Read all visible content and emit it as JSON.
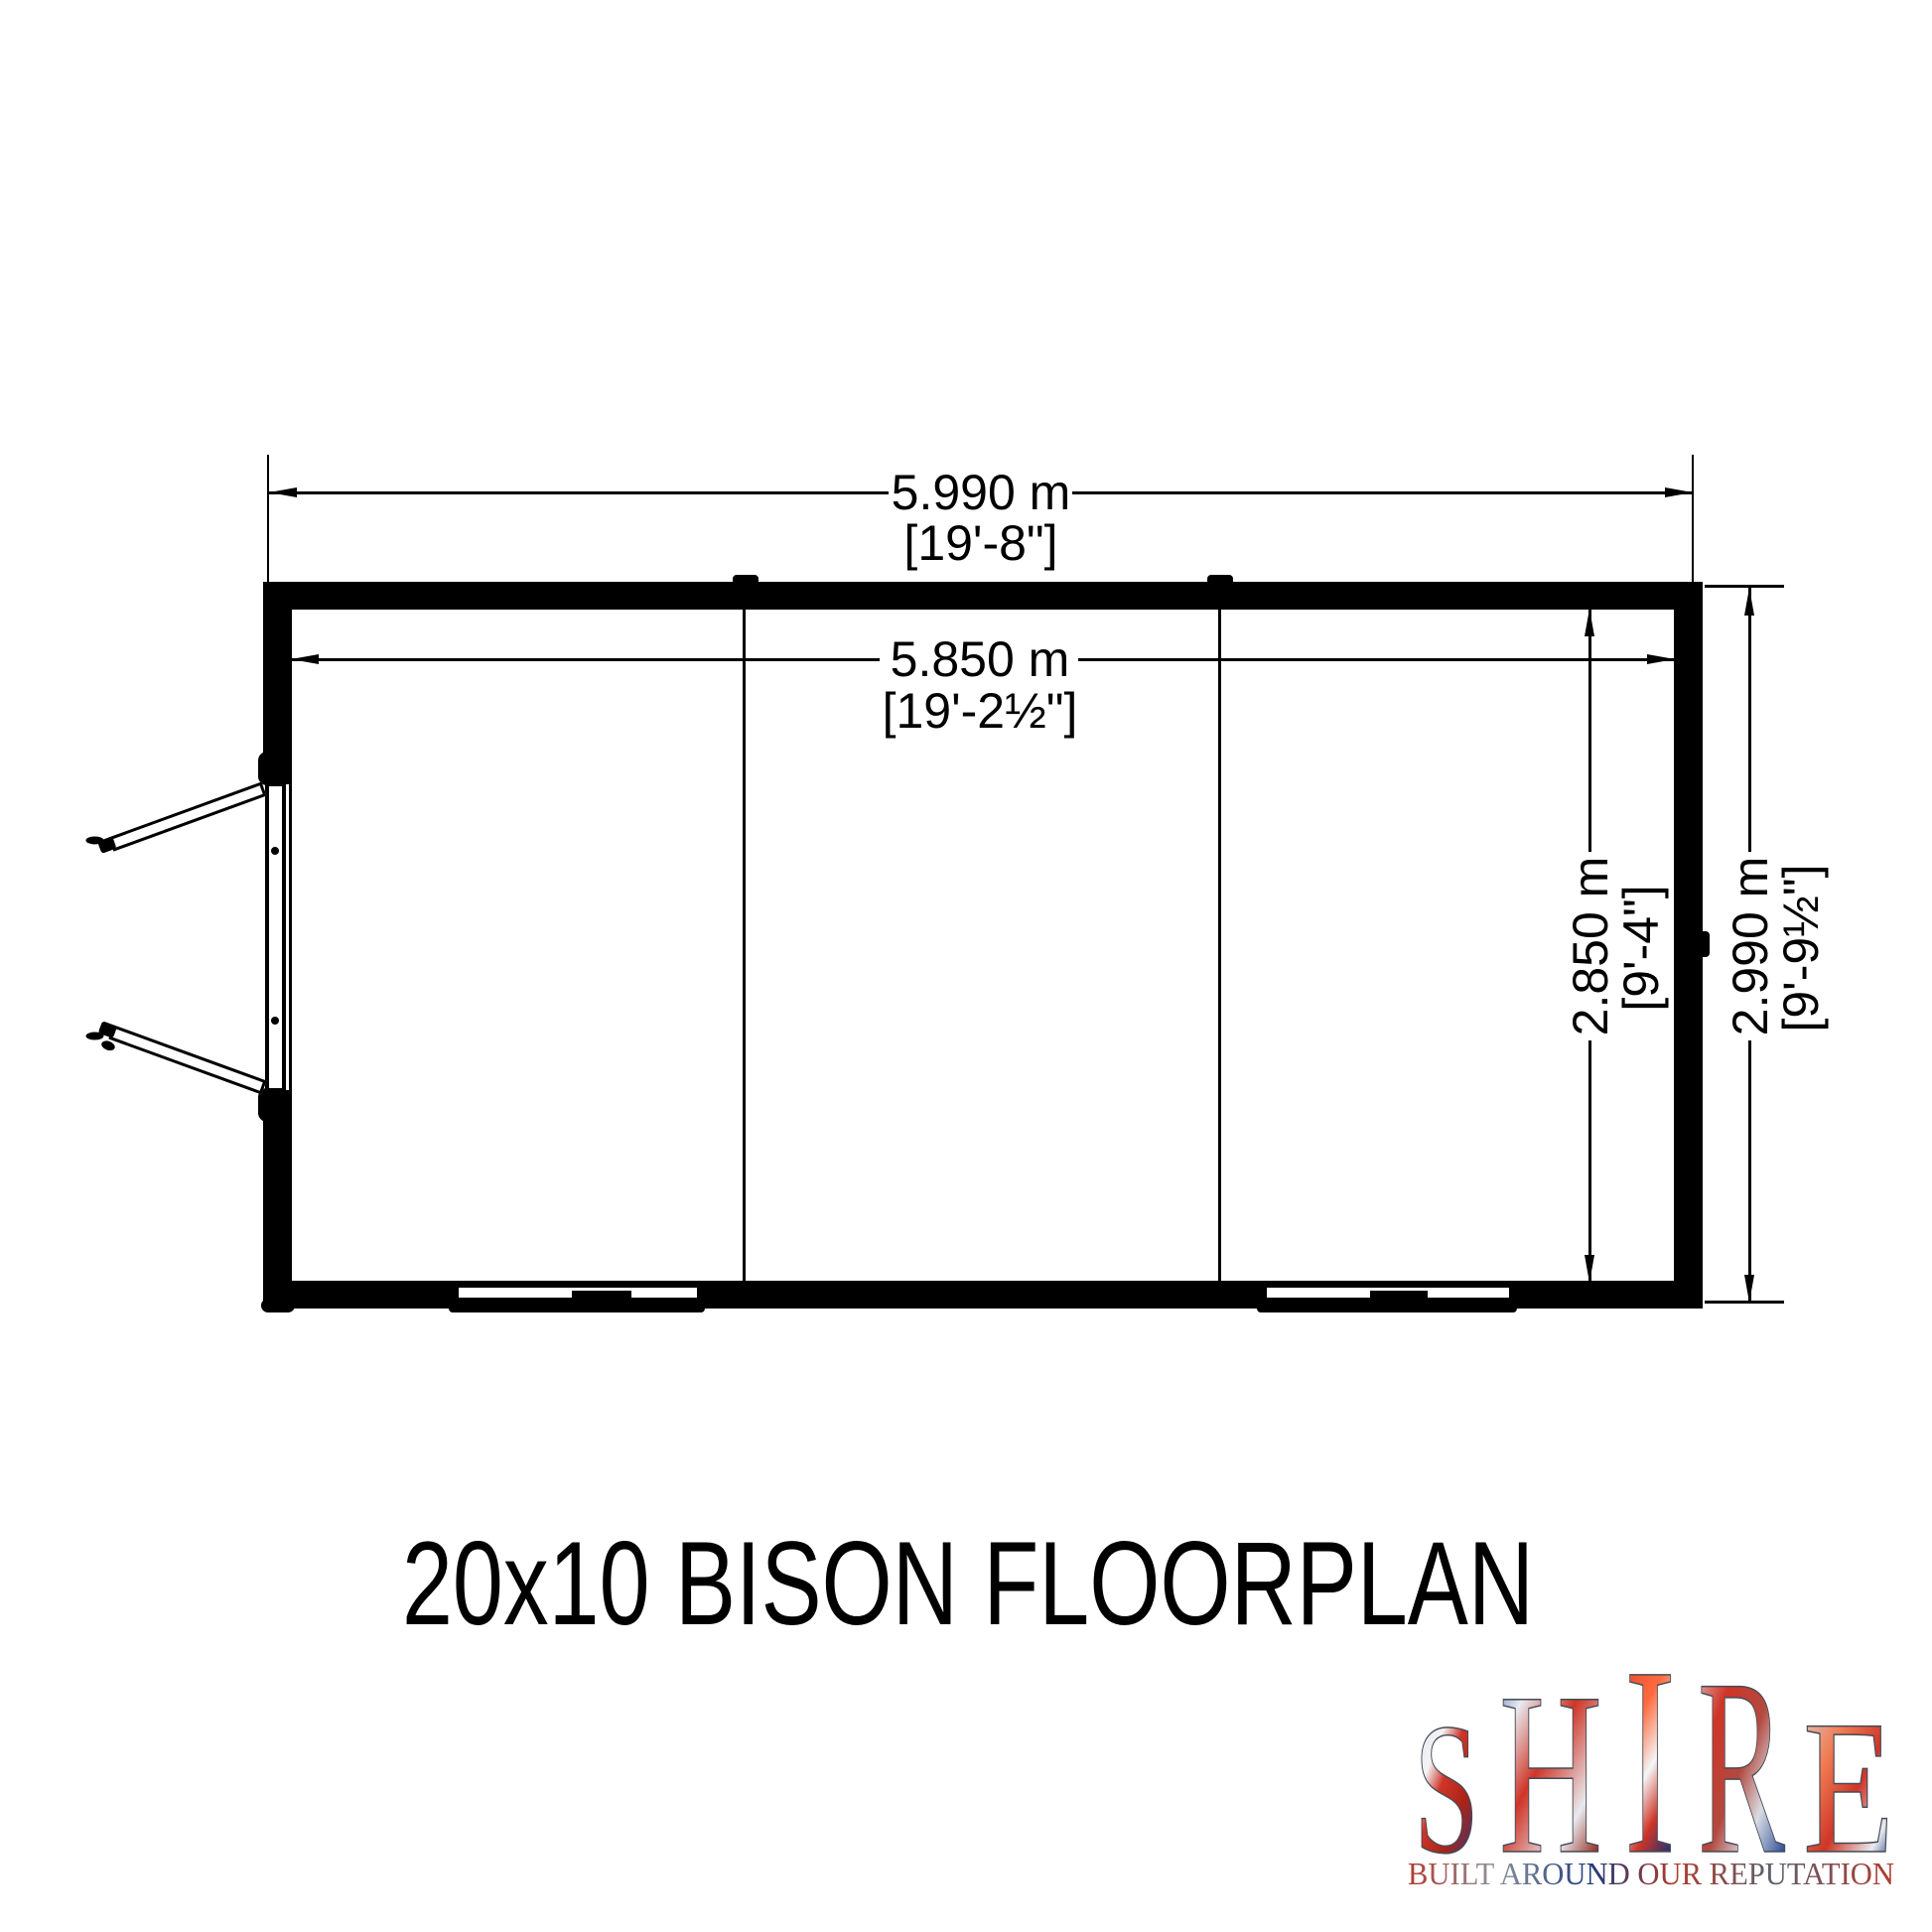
{
  "title": "20x10 BISON FLOORPLAN",
  "dimensions": {
    "width_outer": {
      "metric": "5.990 m",
      "imperial": "[19'-8\"]"
    },
    "width_inner": {
      "metric": "5.850 m",
      "imperial": "[19'-2½\"]"
    },
    "depth_inner": {
      "metric": "2.850 m",
      "imperial": "[9'-4\"]"
    },
    "depth_outer": {
      "metric": "2.990 m",
      "imperial": "[9'-9½\"]"
    }
  },
  "logo": {
    "letters": [
      "S",
      "H",
      "I",
      "R",
      "E"
    ],
    "tagline": "BUILT AROUND OUR REPUTATION"
  },
  "colors": {
    "ink": "#000000",
    "background": "#ffffff",
    "flag_red": "#cf3527",
    "flag_blue": "#1d3c8f",
    "flag_silver": "#d8dce3"
  }
}
